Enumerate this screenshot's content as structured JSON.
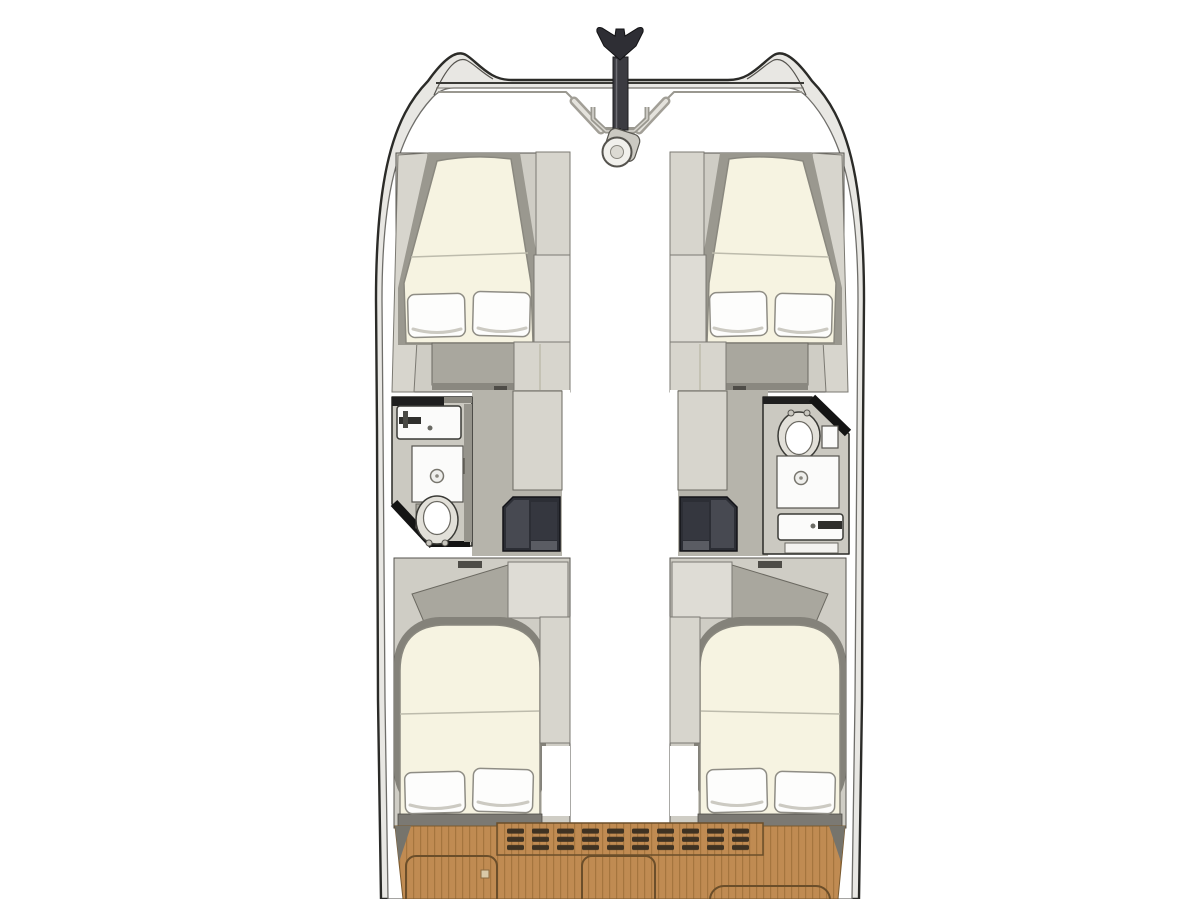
{
  "floor_plan": {
    "type": "catamaran-cabin-layout",
    "view": "top-down",
    "visible_text": [],
    "areas": [
      "bow-anchor-and-windlass",
      "forward-cabin-port",
      "forward-cabin-starboard",
      "head-port",
      "head-starboard",
      "companionway-steps-port",
      "companionway-steps-starboard",
      "aft-cabin-port",
      "aft-cabin-starboard",
      "cockpit-teak-deck"
    ],
    "fixtures": {
      "beds": 4,
      "pillows_per_bed": 2,
      "sinks": 2,
      "showers": 2,
      "toilets": 2,
      "deck_hatches": 3,
      "vent_grate": 1
    }
  },
  "colors": {
    "hull_outline": "#2b2b28",
    "hull_band": "#e8e7e3",
    "interior": "#ffffff",
    "furniture_light": "#d7d5cd",
    "furniture_mid": "#a9a79e",
    "furniture_dark": "#84827a",
    "mattress": "#f6f3e1",
    "pillow": "#fdfdfc",
    "steps": "#2c2e35",
    "bathroom_floor": "#cbc9c1",
    "fixture_white": "#fbfbfa",
    "teak": "#c08b52",
    "teak_stripe": "#a5753e",
    "teak_frame": "#6b4e2a",
    "grate_slat": "#3f3222",
    "anchor": "#2e2e34"
  }
}
